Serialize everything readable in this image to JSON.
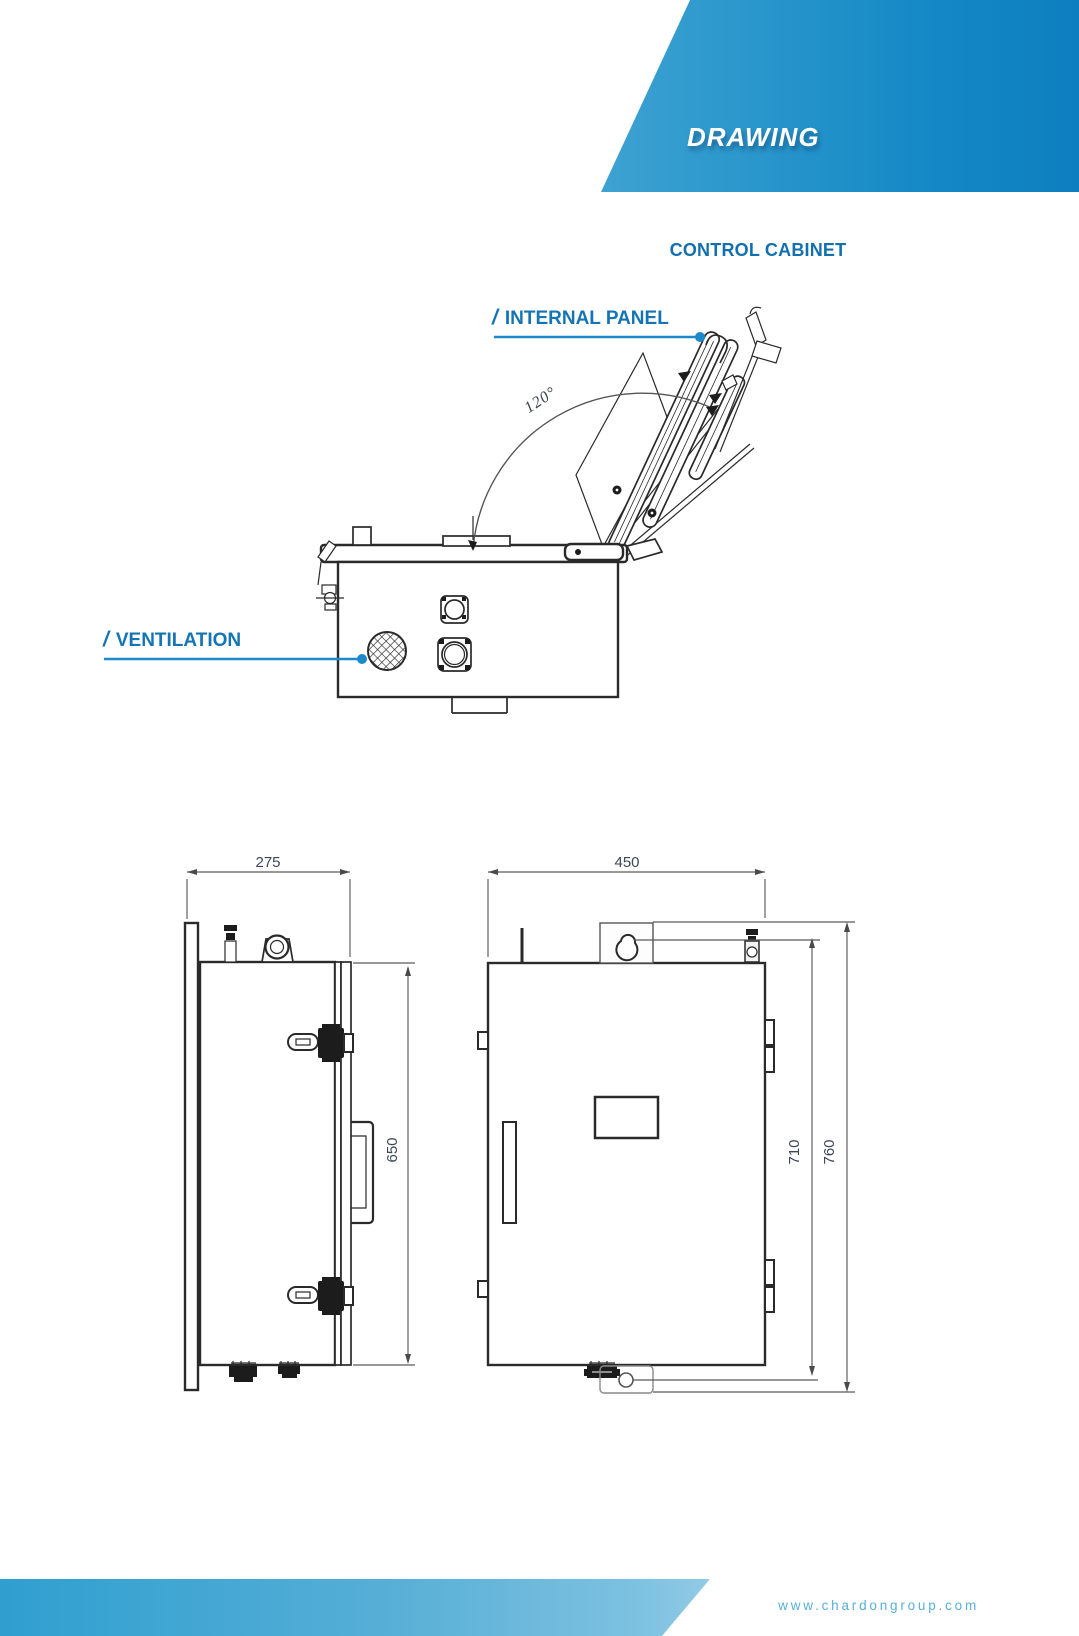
{
  "banner": {
    "title": "DRAWING"
  },
  "section": {
    "title": "CONTROL CABINET"
  },
  "callouts": {
    "internal_panel": {
      "slash": "/",
      "label": "INTERNAL PANEL"
    },
    "ventilation": {
      "slash": "/",
      "label": "VENTILATION"
    }
  },
  "figure": {
    "angle": "120°"
  },
  "dimensions": {
    "side_view": {
      "width": "275",
      "height": "650"
    },
    "front_view": {
      "width": "450",
      "inner_height": "710",
      "total_height": "760"
    }
  },
  "footer": {
    "url": "www.chardongroup.com"
  },
  "colors": {
    "accent_text_blue": "#1575b4",
    "leader_blue": "#1d89cb",
    "band_light_blue": "#66b9dc",
    "band_deep_blue": "#0d7fc0",
    "dim_text": "#3d4657",
    "line_dark": "#2a2a2a"
  }
}
